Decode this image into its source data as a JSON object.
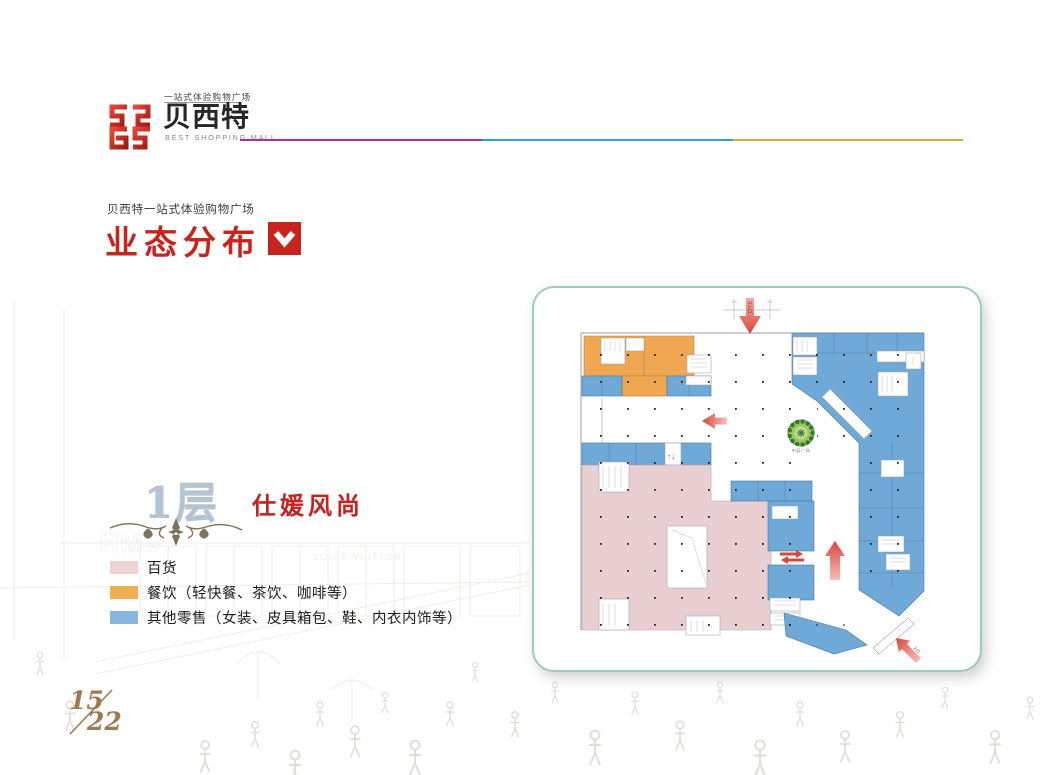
{
  "logo": {
    "tagline": "一站式体验购物广场",
    "name": "贝西特",
    "subtitle": "BEST SHOPPING MALL"
  },
  "header_rule_colors": [
    "#a43795",
    "#2e9fd4",
    "#e6a23c"
  ],
  "title": {
    "eyebrow": "贝西特一站式体验购物广场",
    "heading": "业态分布"
  },
  "floor": {
    "number_label": "1层",
    "theme": "仕媛风尚"
  },
  "legend": {
    "items": [
      {
        "label": "百货",
        "color": "#eed3d5"
      },
      {
        "label": "餐饮（轻快餐、茶饮、咖啡等）",
        "color": "#f0ae54"
      },
      {
        "label": "其他零售（女装、皮具箱包、鞋、内衣内饰等）",
        "color": "#85b7e0"
      }
    ]
  },
  "plan": {
    "tree_label": "中庭广场",
    "top_entrance_label": "主入口",
    "side_entrance_label": "入口",
    "escalator_glyph": "↑↓",
    "colors": {
      "department_pink": "#e9ced2",
      "dining_orange": "#efa751",
      "retail_blue": "#6ea9d8",
      "arrow_red": "#d9463c",
      "card_border": "#9ecdb6"
    }
  },
  "watermark_texts": [
    "HMV",
    "LOUIS VUITTON"
  ],
  "page": {
    "current": "15",
    "total": "22"
  }
}
